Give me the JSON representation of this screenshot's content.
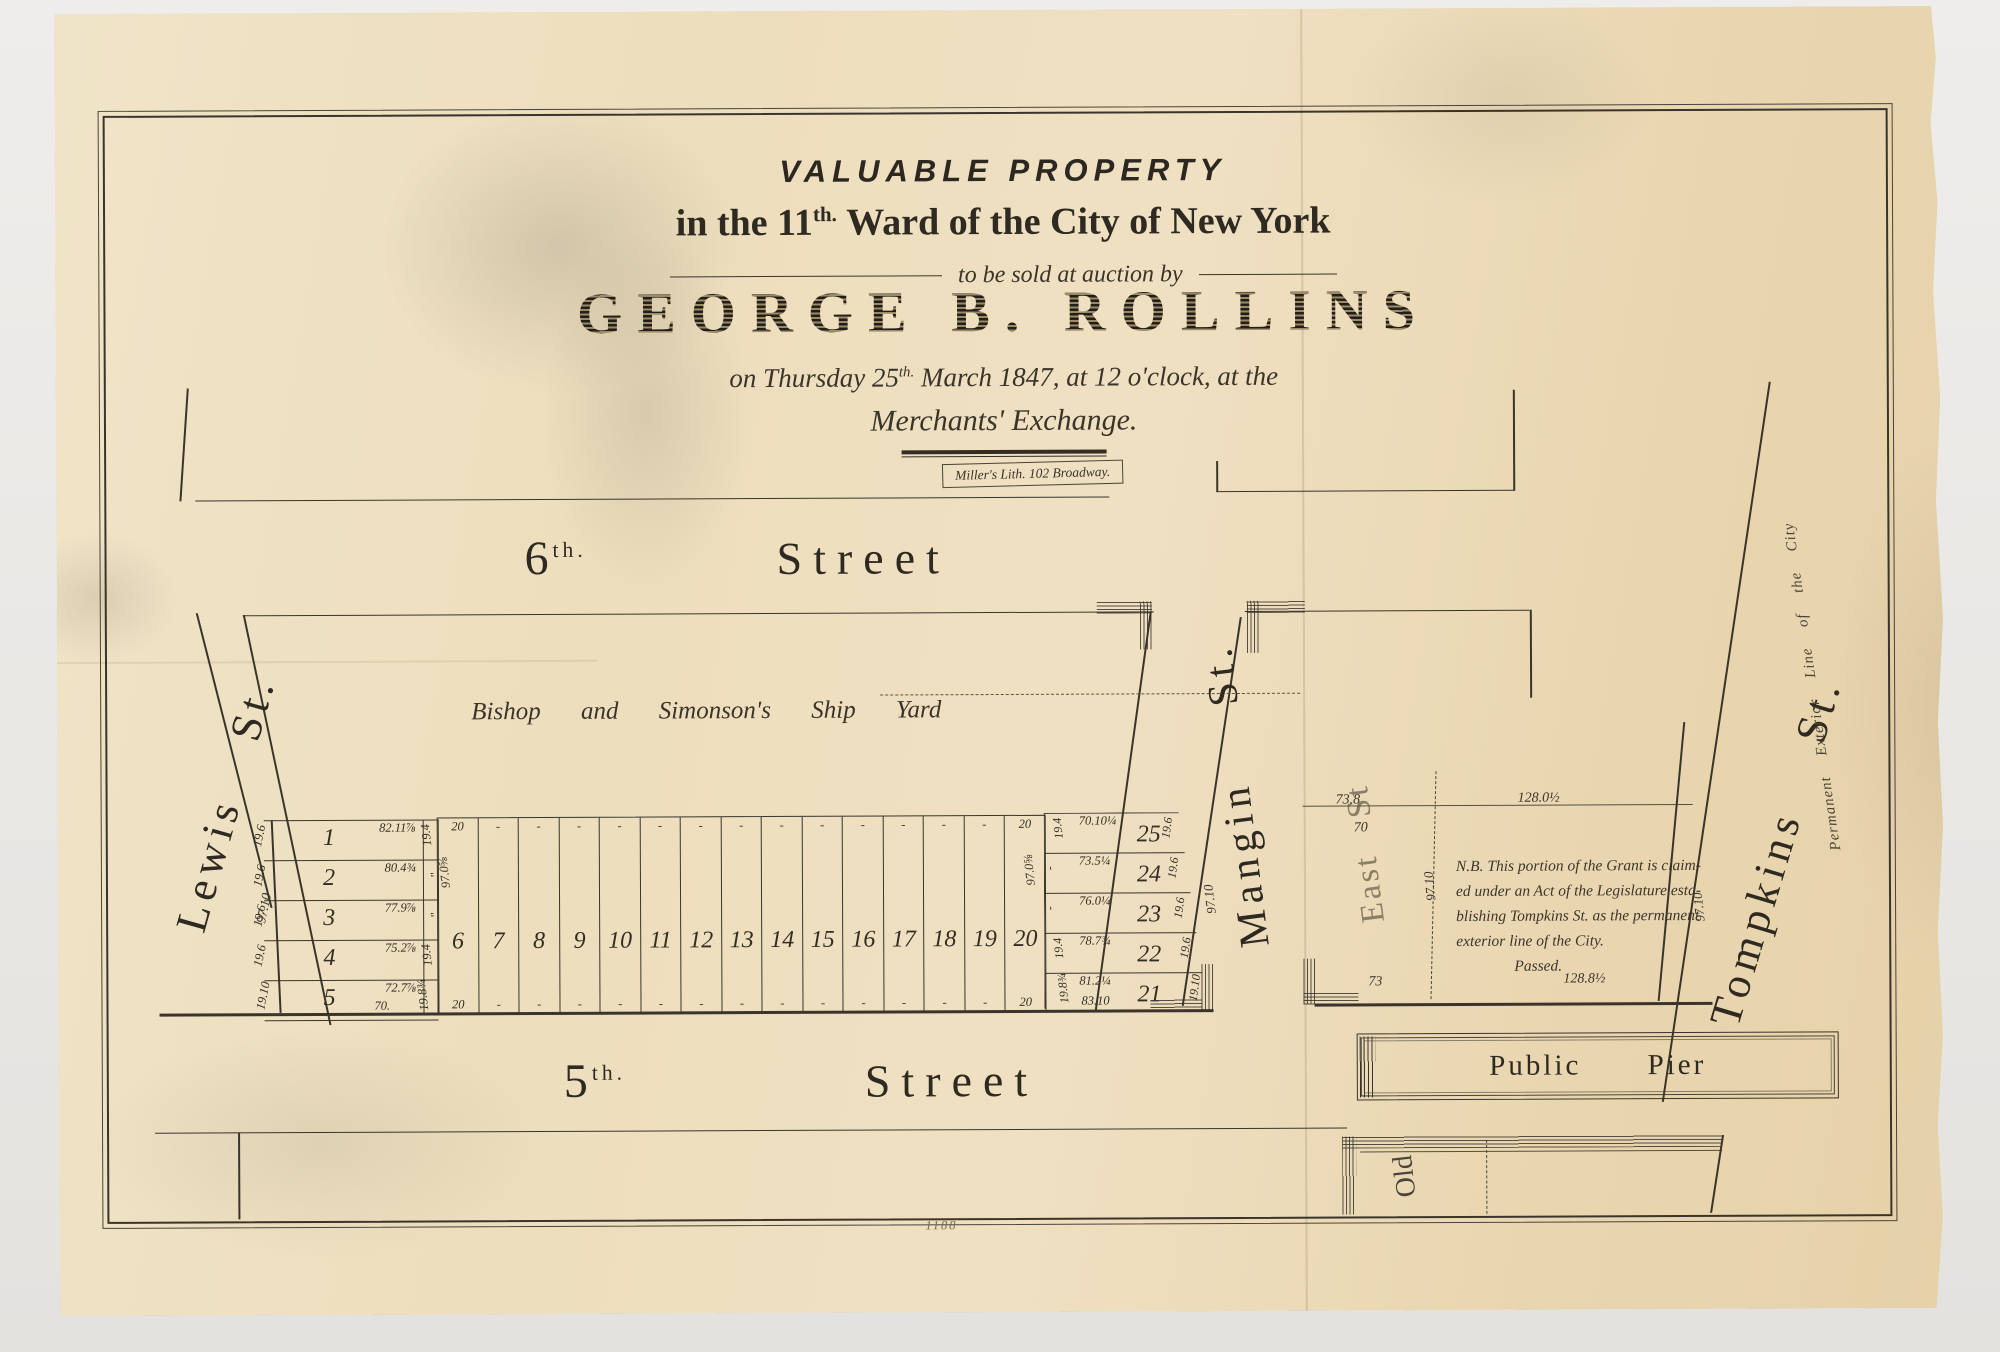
{
  "artwork": {
    "paper_color": "#ecdcba",
    "ink_color": "#352f26",
    "plate_number": "1188"
  },
  "title": {
    "line1": "VALUABLE PROPERTY",
    "line2_pre": "in the 11",
    "line2_sup": "th.",
    "line2_post": "Ward of the City of New York",
    "auction_line": "to be sold at auction by",
    "auctioneer": "GEORGE B. ROLLINS",
    "date_pre": "on Thursday  25",
    "date_sup": "th.",
    "date_post": "March 1847, at 12 o'clock, at the",
    "venue": "Merchants' Exchange.",
    "imprint": "Miller's Lith. 102 Broadway."
  },
  "streets": {
    "sixth_prefix": "6",
    "sixth_sup": "th.",
    "sixth_name": "Street",
    "fifth_prefix": "5",
    "fifth_sup": "th.",
    "fifth_name": "Street",
    "lewis": "Lewis  St.",
    "mangin": "Mangin  St.",
    "east": "East  St",
    "tompkins": "Tompkins  St.",
    "public_pier": "Public  Pier",
    "old_pier": "Old",
    "exterior_line": "Permanent  Exterior  Line  of  the  City",
    "ship_yard": "Bishop and Simonson's Ship Yard"
  },
  "left_block": {
    "gore_depth": "97.10",
    "lots": [
      {
        "number": "1",
        "frontage": "82.11⅞",
        "left": "19.6",
        "right": "19.4"
      },
      {
        "number": "2",
        "frontage": "80.4¾",
        "left": "19.6",
        "right": "\""
      },
      {
        "number": "3",
        "frontage": "77.9⅞",
        "left": "19.6",
        "right": "\""
      },
      {
        "number": "4",
        "frontage": "75.2⅞",
        "left": "19.6",
        "right": "19.4"
      },
      {
        "number": "5",
        "frontage": "72.7⅞",
        "left": "19.10",
        "right": "19.8¾"
      }
    ],
    "lot5_bottom": "70."
  },
  "middle_block": {
    "depth_left": "97.0⅝",
    "depth_right": "97.0⅝",
    "lots": [
      {
        "number": "6",
        "top": "20",
        "bottom": "20"
      },
      {
        "number": "7",
        "top": "-",
        "bottom": "-"
      },
      {
        "number": "8",
        "top": "-",
        "bottom": "-"
      },
      {
        "number": "9",
        "top": "-",
        "bottom": "-"
      },
      {
        "number": "10",
        "top": "-",
        "bottom": "-"
      },
      {
        "number": "11",
        "top": "-",
        "bottom": "-"
      },
      {
        "number": "12",
        "top": "-",
        "bottom": "-"
      },
      {
        "number": "13",
        "top": "-",
        "bottom": "-"
      },
      {
        "number": "14",
        "top": "-",
        "bottom": "-"
      },
      {
        "number": "15",
        "top": "-",
        "bottom": "-"
      },
      {
        "number": "16",
        "top": "-",
        "bottom": "-"
      },
      {
        "number": "17",
        "top": "-",
        "bottom": "-"
      },
      {
        "number": "18",
        "top": "-",
        "bottom": "-"
      },
      {
        "number": "19",
        "top": "-",
        "bottom": "-"
      },
      {
        "number": "20",
        "top": "20",
        "bottom": "20"
      }
    ]
  },
  "right_block": {
    "mangin_depth": "97.10",
    "lot21_bottom": "83.10",
    "lots": [
      {
        "number": "25",
        "frontage": "70.10¼",
        "left": "19.4",
        "right": "19.6"
      },
      {
        "number": "24",
        "frontage": "73.5¼",
        "left": "-",
        "right": "19.6"
      },
      {
        "number": "23",
        "frontage": "76.0¼",
        "left": "-",
        "right": "19.6"
      },
      {
        "number": "22",
        "frontage": "78.7¾",
        "left": "19.4",
        "right": "19.6"
      },
      {
        "number": "21",
        "frontage": "81.2¼",
        "left": "19.8¾",
        "right": "19.10"
      }
    ]
  },
  "east_block": {
    "top_left": "73.8",
    "top_right": "128.0½",
    "upper_left": "70",
    "bottom_left": "73",
    "bottom_right": "128.8½",
    "dashed_depth": "97.10",
    "east_depth": "97.10",
    "note_lines": [
      "N.B. This portion of the Grant is claim-",
      "ed under an Act of the Legislature esta-",
      "blishing Tompkins St. as the permanent",
      "exterior line of the City.",
      "Passed."
    ]
  }
}
